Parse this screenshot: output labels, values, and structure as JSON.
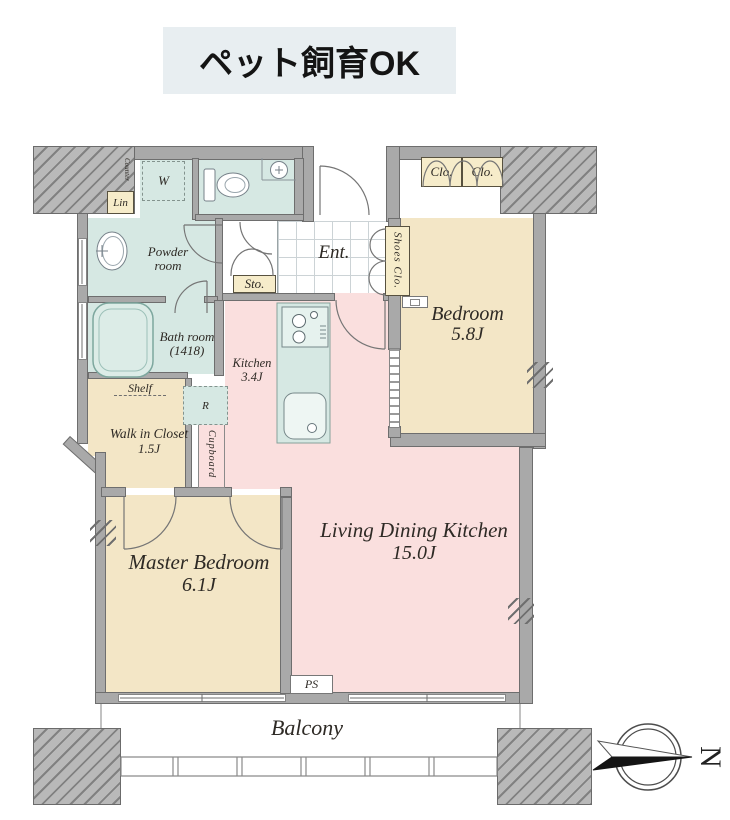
{
  "banner": {
    "text": "ペット飼育OK"
  },
  "rooms": {
    "entrance": {
      "abbr": "Ent."
    },
    "powder_room": {
      "name": "Powder room"
    },
    "bath_room": {
      "name": "Bath room",
      "dimensions": "(1418)"
    },
    "kitchen": {
      "name": "Kitchen",
      "size": "3.4J"
    },
    "bedroom": {
      "name": "Bedroom",
      "size": "5.8J"
    },
    "master_bedroom": {
      "name": "Master Bedroom",
      "size": "6.1J"
    },
    "living_dining_kitchen": {
      "name": "Living Dining Kitchen",
      "size": "15.0J"
    },
    "walk_in_closet": {
      "name": "Walk in Closet",
      "size": "1.5J"
    },
    "balcony": {
      "name": "Balcony"
    }
  },
  "storage": {
    "storage_abbr": "Sto.",
    "shoes_closet": "Shoes Clo.",
    "closet_left": "Clo.",
    "closet_right": "Clo.",
    "linen": "Lin",
    "shelf": "Shelf",
    "cupboard": "Cupboard"
  },
  "equipment": {
    "washing_machine_abbr": "W",
    "refrigerator_abbr": "R",
    "counter": "Counter",
    "pipe_space_abbr": "PS"
  },
  "compass": {
    "north_label": "N"
  },
  "colors": {
    "wall": "#a9a9a9",
    "wet_area_teal": "#d6e8e3",
    "ldk_pink": "#fadfde",
    "bedroom_beige": "#f3e6c6",
    "label_box_beige": "#f6ecca",
    "banner_bg": "#e8eef1"
  }
}
